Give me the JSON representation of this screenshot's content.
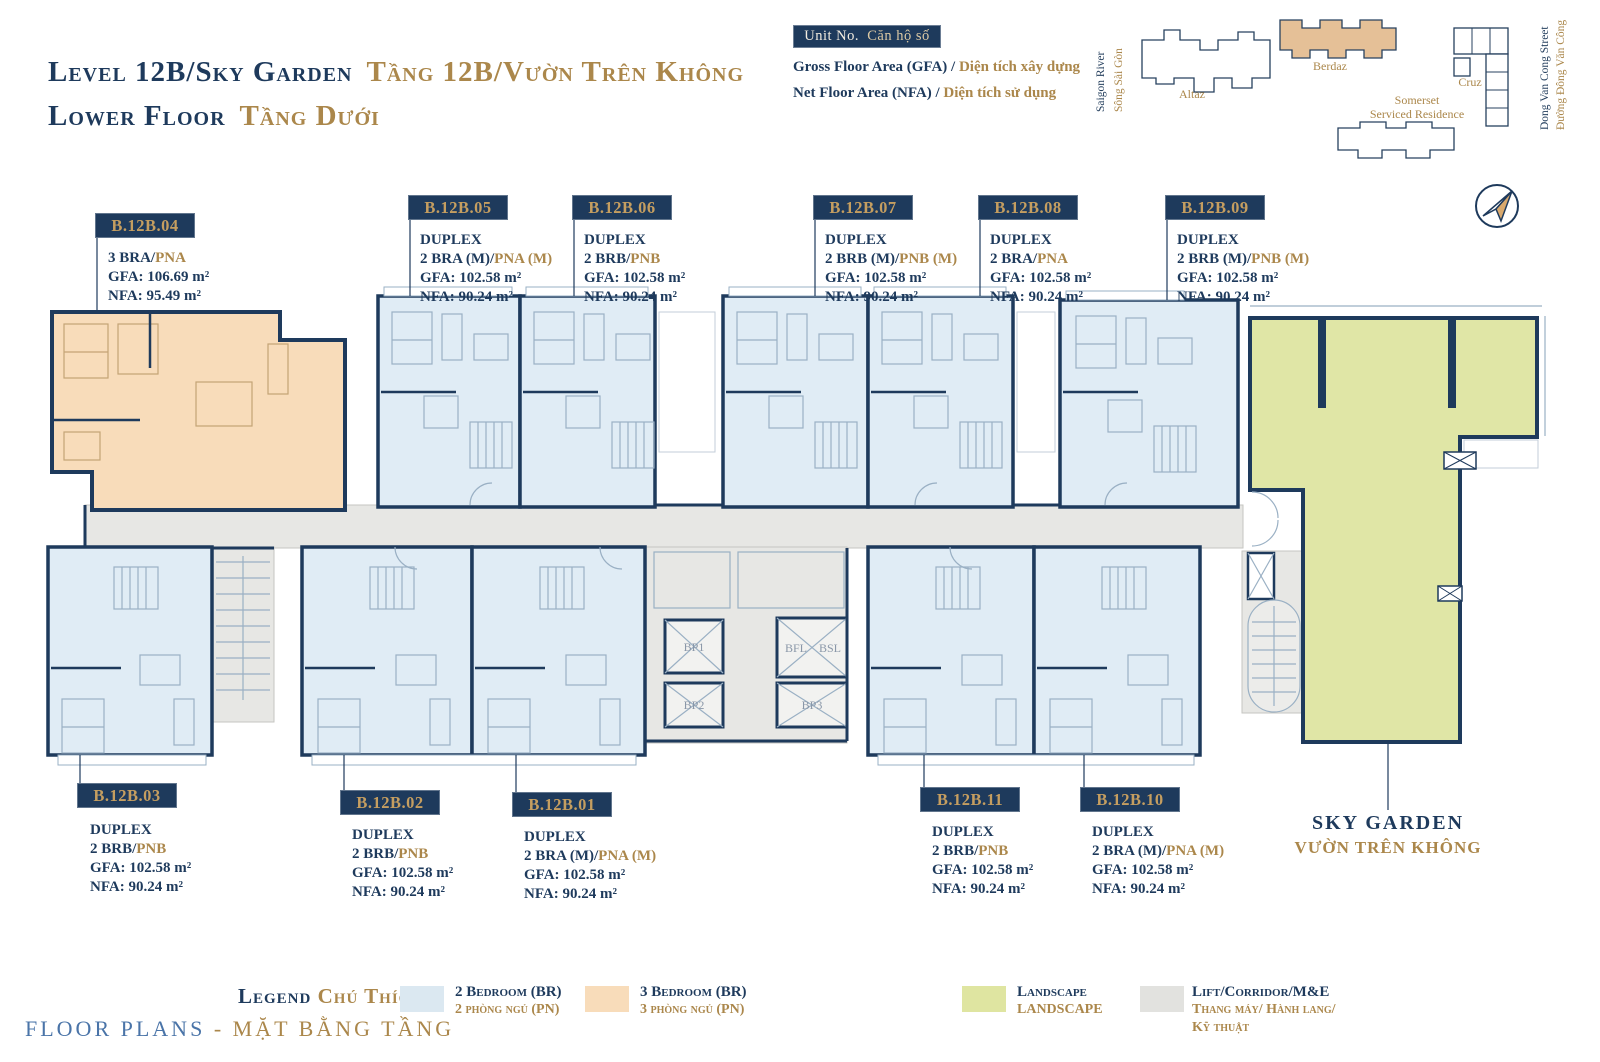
{
  "header": {
    "title_en": "Level 12B/Sky Garden",
    "title_vi": "Tầng 12B/Vườn Trên Không",
    "subtitle_en": "Lower Floor",
    "subtitle_vi": "Tầng Dưới",
    "unit_no_en": "Unit No.",
    "unit_no_vi": "Căn hộ số",
    "gfa_en": "Gross Floor Area (GFA) /",
    "gfa_vi": "Diện tích xây dựng",
    "nfa_en": "Net Floor Area (NFA) /",
    "nfa_vi": "Diện tích sử dụng"
  },
  "site_map": {
    "river_en": "Saigon River",
    "river_vi": "Sông Sài Gòn",
    "altaz": "Altaz",
    "berdaz": "Berdaz",
    "somerset_1": "Somerset",
    "somerset_2": "Serviced Residence",
    "cruz": "Cruz",
    "street_en": "Dong Van Cong Street",
    "street_vi": "Đường Đông Văn Công"
  },
  "plan": {
    "units": [
      {
        "id": "B.12B.04",
        "type": "3 BRA/",
        "type_gold": "PNA",
        "gfa": "GFA: 106.69 m²",
        "nfa": "NFA: 95.49 m²"
      },
      {
        "id": "B.12B.05",
        "duplex": "DUPLEX",
        "type": "2 BRA (M)/",
        "type_gold": "PNA (M)",
        "gfa": "GFA: 102.58 m²",
        "nfa": "NFA: 90.24 m²"
      },
      {
        "id": "B.12B.06",
        "duplex": "DUPLEX",
        "type": "2 BRB/",
        "type_gold": "PNB",
        "gfa": "GFA: 102.58 m²",
        "nfa": "NFA: 90.24 m²"
      },
      {
        "id": "B.12B.07",
        "duplex": "DUPLEX",
        "type": "2 BRB (M)/",
        "type_gold": "PNB (M)",
        "gfa": "GFA: 102.58 m²",
        "nfa": "NFA: 90.24 m²"
      },
      {
        "id": "B.12B.08",
        "duplex": "DUPLEX",
        "type": "2 BRA/",
        "type_gold": "PNA",
        "gfa": "GFA: 102.58 m²",
        "nfa": "NFA: 90.24 m²"
      },
      {
        "id": "B.12B.09",
        "duplex": "DUPLEX",
        "type": "2 BRB (M)/",
        "type_gold": "PNB (M)",
        "gfa": "GFA: 102.58 m²",
        "nfa": "NFA: 90.24 m²"
      },
      {
        "id": "B.12B.03",
        "duplex": "DUPLEX",
        "type": "2 BRB/",
        "type_gold": "PNB",
        "gfa": "GFA: 102.58 m²",
        "nfa": "NFA: 90.24 m²"
      },
      {
        "id": "B.12B.02",
        "duplex": "DUPLEX",
        "type": "2 BRB/",
        "type_gold": "PNB",
        "gfa": "GFA: 102.58 m²",
        "nfa": "NFA: 90.24 m²"
      },
      {
        "id": "B.12B.01",
        "duplex": "DUPLEX",
        "type": "2 BRA (M)/",
        "type_gold": "PNA (M)",
        "gfa": "GFA: 102.58 m²",
        "nfa": "NFA: 90.24 m²"
      },
      {
        "id": "B.12B.11",
        "duplex": "DUPLEX",
        "type": "2 BRB/",
        "type_gold": "PNB",
        "gfa": "GFA: 102.58 m²",
        "nfa": "NFA: 90.24 m²"
      },
      {
        "id": "B.12B.10",
        "duplex": "DUPLEX",
        "type": "2 BRA (M)/",
        "type_gold": "PNA (M)",
        "gfa": "GFA: 102.58 m²",
        "nfa": "NFA: 90.24 m²"
      }
    ],
    "lifts": {
      "bp1": "BP1",
      "bp2": "BP2",
      "bfl": "BFL",
      "bsl": "BSL",
      "bp3": "BP3"
    },
    "sky_garden_en": "SKY GARDEN",
    "sky_garden_vi": "VƯỜN TRÊN KHÔNG"
  },
  "legend": {
    "title_en": "Legend",
    "title_vi": "Chú Thích",
    "items": [
      {
        "en": "2 Bedroom (BR)",
        "vi": "2 phòng ngủ (PN)",
        "color": "#dbe8f1"
      },
      {
        "en": "3 Bedroom (BR)",
        "vi": "3 phòng ngủ (PN)",
        "color": "#f8dcba"
      },
      {
        "en": "Landscape",
        "vi": "LANDSCAPE",
        "color": "#dfe5a1"
      },
      {
        "en": "Lift/Corridor/M&E",
        "vi": "Thang máy/ Hành lang/",
        "vi2": "Kỹ thuật",
        "color": "#e2e2df"
      }
    ]
  },
  "footer": {
    "en": "FLOOR PLANS",
    "vi": "- MẶT BẰNG TẦNG"
  },
  "colors": {
    "navy": "#1e3a5c",
    "gold": "#ab874b",
    "blue_2br": "#e0ecf5",
    "tan_3br": "#f8dcba",
    "green_landscape": "#e0e6a6",
    "gray_corridor": "#e7e7e4"
  }
}
